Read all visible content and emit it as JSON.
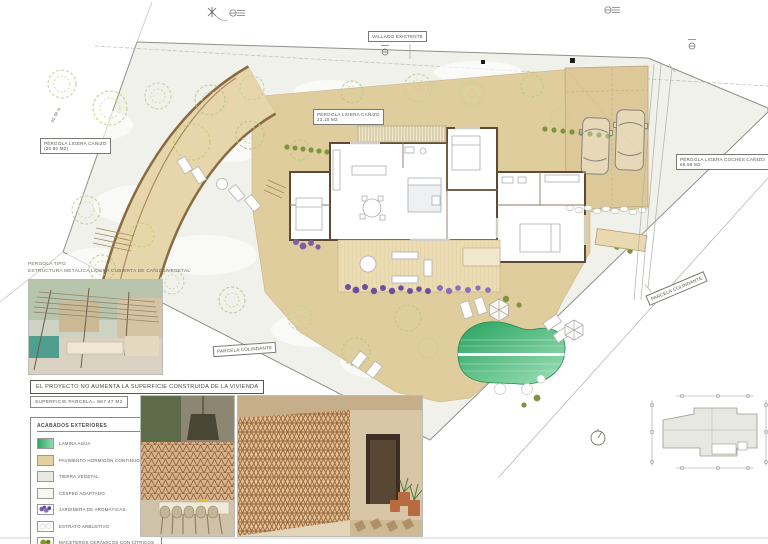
{
  "sheet": {
    "statement": "EL PROYECTO NO AUMENTA LA SUPERFICIE CONSTRUIDA DE LA VIVIENDA",
    "superficie": "SUPERFICIE PARCELA= 867.47 M2"
  },
  "pergola_note": {
    "line1": "PÉRGOLA TIPO",
    "line2": "ESTRUCTURA METÁLICA LIGERA CUBIERTA DE CAÑIZO/VEGETAL"
  },
  "plan_labels": {
    "vallado": "VALLADO EXISTENTE",
    "pergola_house_l1": "PÉRGOLA LIGERA CAÑIZO",
    "pergola_house_l2": "23.10 M2",
    "pergola_left_l1": "PÉRGOLA LIGERA CAÑIZO",
    "pergola_left_l2": "(20.80 M2)",
    "pergola_parking_l1": "PÉRGOLA LIGERA COCHES CAÑIZO",
    "pergola_parking_l2": "66.56 M2",
    "parcela_right": "PARCELA COLINDANTE",
    "parcela_bottom": "PARCELA COLINDANTE",
    "dim_left": "30.98 m"
  },
  "legend": {
    "title": "ACABADOS  EXTERIORES",
    "items": [
      {
        "label": "LÁMINA AGUA",
        "swatch": "agua"
      },
      {
        "label": "PAVIMENTO HORMIGÓN CONTINUO",
        "swatch": "pavimento"
      },
      {
        "label": "TIERRA VEGETAL",
        "swatch": "tierra"
      },
      {
        "label": "CÉSPED ADAPTADO",
        "swatch": "cesped"
      },
      {
        "label": "JARDINERA  DE AROMÁTICAS",
        "swatch": "jardinera"
      },
      {
        "label": "ESTRATO ARBUSTIVO",
        "swatch": "arbustivo"
      },
      {
        "label": "MACETEROS CERÁMICOS CON CÍTRICOS",
        "swatch": "maceteros"
      }
    ]
  },
  "colors": {
    "paving": "#e0cd9e",
    "ground": "#f0f1ea",
    "pool_dark": "#27a35e",
    "pool_light": "#9fe0b8",
    "wall": "#5e4936",
    "jardinera": "#7b5ea7"
  }
}
